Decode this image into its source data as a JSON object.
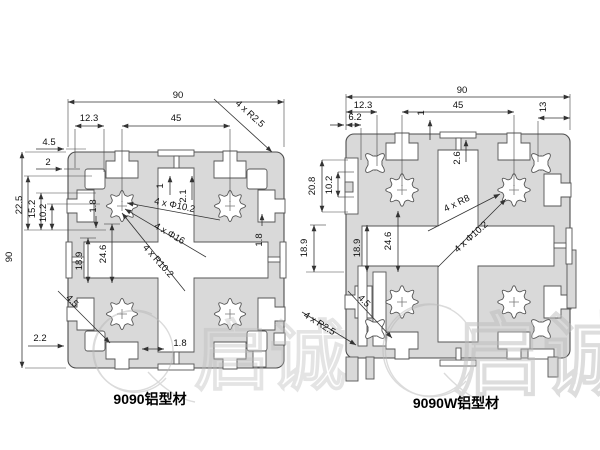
{
  "colors": {
    "background": "#ffffff",
    "profile_fill": "#d9d9d9",
    "profile_stroke": "#4d4d4d",
    "dim_line": "#333333",
    "dim_text": "#111111",
    "watermark": "#bdbdbd"
  },
  "left_profile": {
    "caption": "9090铝型材",
    "dims": {
      "total_width": "90",
      "total_height": "90",
      "slot_offset": "12.3",
      "slot_spacing": "45",
      "corner_radius": "4 x R2.5",
      "top_wall_a": "4.5",
      "top_wall_b": "2",
      "side_a": "22.5",
      "side_b": "15.2",
      "side_c": "10.2",
      "wall_top_left": "1.8",
      "groove_width": "1",
      "groove_depth": "2.1",
      "wall_top_right": "1.8",
      "hole_dia": "4 x Φ10.2",
      "boss_dia": "4 x Φ16",
      "cavity_radius": "4 x R10.2",
      "cavity_a": "18.9",
      "cavity_b": "24.6",
      "fillet_bottom": "4.5",
      "bottom_offset": "2.2",
      "wall_bottom": "1.8"
    }
  },
  "right_profile": {
    "caption": "9090W铝型材",
    "dims": {
      "total_width": "90",
      "slot_offset": "12.3",
      "slot_offset_b": "6.2",
      "slot_spacing": "45",
      "corner_offset": "13",
      "groove_width": "1",
      "groove_depth": "2.6",
      "recess_depth": "20.8",
      "recess_width": "10.2",
      "cavity_a": "18.9",
      "cavity_b": "18.9",
      "cavity_c": "24.6",
      "boss_radius": "4 x R8",
      "hole_dia": "4 x Φ10.2",
      "corner_radius": "4 x R2.5",
      "fillet_bottom": "4.5"
    }
  },
  "watermark": {
    "text": "启诚"
  }
}
